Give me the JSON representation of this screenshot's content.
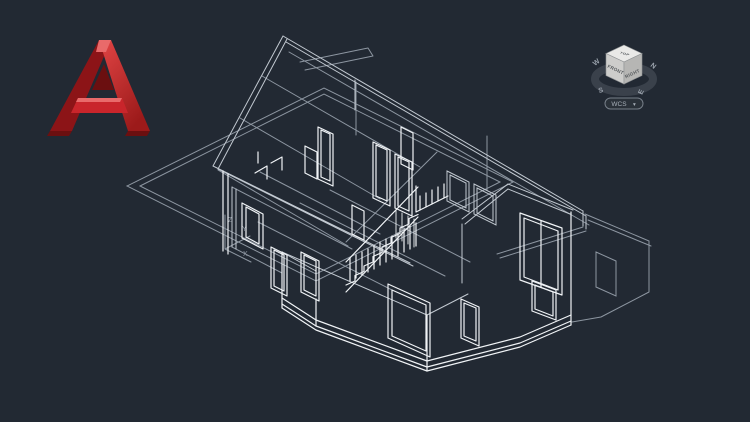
{
  "scene": {
    "background": "#222933",
    "description": "3D wireframe model of a two-story house shown in an AutoCAD viewport, south-west isometric view"
  },
  "palette": {
    "line_bright": "#f0f3f6",
    "line_mid": "#c2c9d1",
    "line_dim": "#8d96a1",
    "logo_red": "#c9252b",
    "logo_red_dark": "#8c1417",
    "logo_red_deep": "#6b0f10",
    "logo_red_light": "#e96a6a",
    "viewcube_ring": "#3a414b",
    "viewcube_letter": "#9ba3ad",
    "viewcube_face_top": "#e9e9e7",
    "viewcube_face_left": "#cdcdcb",
    "viewcube_face_right": "#b6b6b4",
    "viewcube_edge": "#8f9294",
    "viewcube_label": "#55595c",
    "pill_bg": "#2a3139",
    "pill_border": "#767e88",
    "pill_text": "#a8b0b9"
  },
  "logo": {
    "name": "AutoCAD",
    "letter": "A"
  },
  "viewcube": {
    "top_face_label": "TOP",
    "front_face_label": "FRONT",
    "right_face_label": "RIGHT",
    "compass_west": "W",
    "compass_north": "N",
    "compass_south": "S",
    "compass_east": "E",
    "wcs_label": "WCS",
    "wcs_caret": "▾"
  },
  "ucs": {
    "x_label": "X",
    "y_label": "Y",
    "z_label": "Z"
  }
}
